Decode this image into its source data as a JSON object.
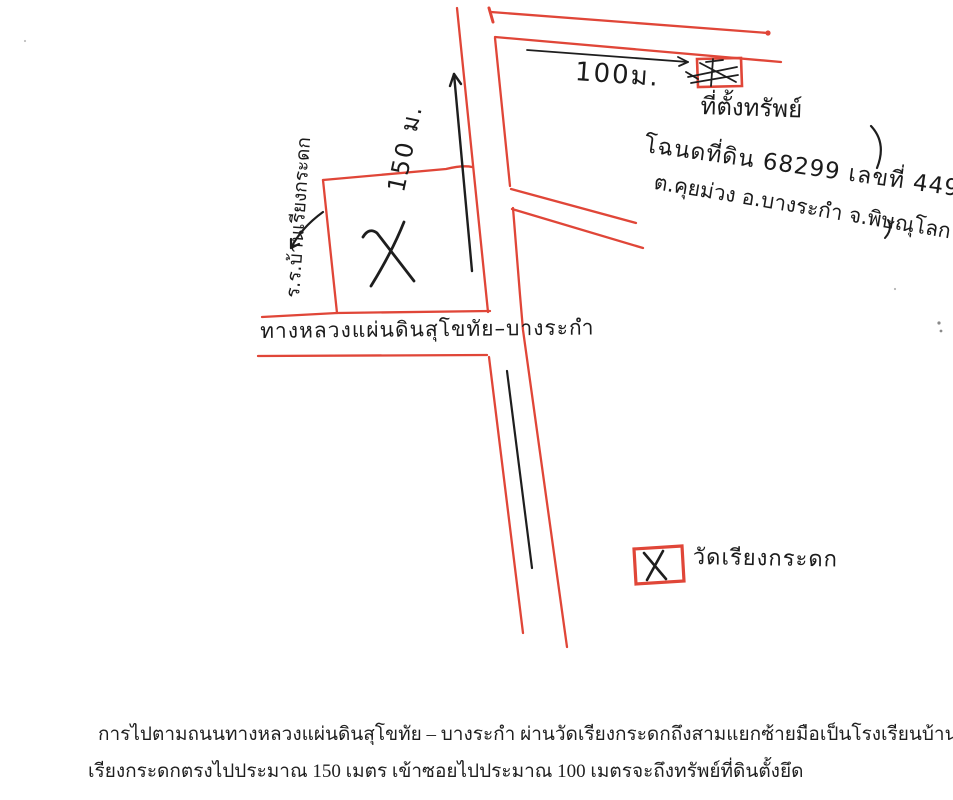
{
  "document": {
    "kind": "scanned hand-drawn directions map to seized property",
    "paper_color": "#ffffff"
  },
  "colors": {
    "pen_red": "#e04638",
    "ink_black": "#1e1e1e",
    "caption_black": "#1f1f1f"
  },
  "map": {
    "distance_soi": "100ม.",
    "distance_road": "150 ม.",
    "property_label": "ที่ตั้งทรัพย์",
    "deed_line1": "โฉนดที่ดิน 68299 เลขที่ 449",
    "deed_line2": "ต.คุยม่วง อ.บางระกำ จ.พิษณุโลก",
    "school_label": "ร.ร.บ้านเรียงกระดก",
    "highway_label": "ทางหลวงแผ่นดินสุโขทัย–บางระกำ",
    "legend": {
      "symbol": "X",
      "label": "วัดเรียงกระดก"
    },
    "symbols": {
      "property_marker": "small red box with black scribble at end of soi",
      "plot_marker": "large black X inside red plot outline",
      "arrows": [
        "150 m arrow pointing up along road",
        "100 m arrow pointing right along soi",
        "curved arrow pointing to school plot"
      ]
    }
  },
  "caption": {
    "line1": "การไปตามถนนทางหลวงแผ่นดินสุโขทัย – บางระกำ ผ่านวัดเรียงกระดกถึงสามแยกซ้ายมือเป็นโรงเรียนบ้าน",
    "line2": "เรียงกระดกตรงไปประมาณ 150 เมตร เข้าซอยไปประมาณ 100 เมตรจะถึงทรัพย์ที่ดินตั้งยึด"
  }
}
